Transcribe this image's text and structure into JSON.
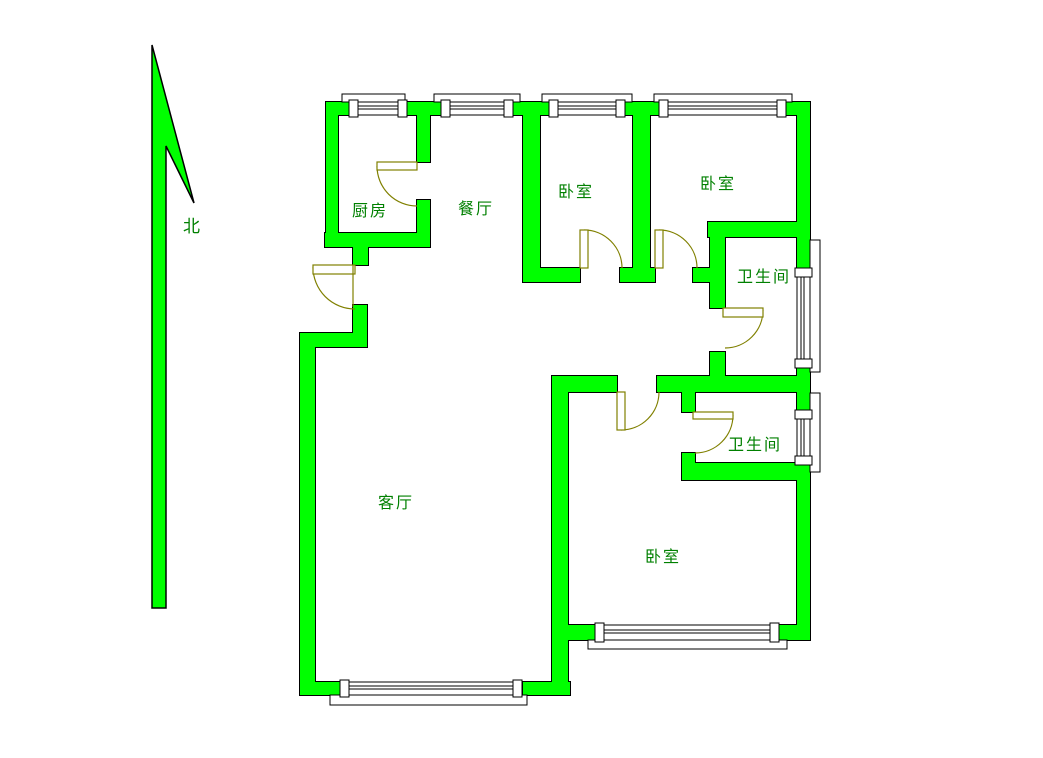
{
  "page": {
    "background": "#ffffff",
    "width": 1043,
    "height": 758
  },
  "colors": {
    "wall_fill": "#00ff00",
    "wall_outline": "#000000",
    "door": "#808000",
    "label_text": "#008000",
    "window_fill": "#ffffff",
    "window_line": "#000000"
  },
  "compass": {
    "label": "北",
    "label_x": 183,
    "label_y": 232,
    "arrow_polygon": "152,45 194,203 166,146 166,608 152,608"
  },
  "rooms": [
    {
      "name": "kitchen",
      "label": "厨房",
      "x": 352,
      "y": 216
    },
    {
      "name": "dining-room",
      "label": "餐厅",
      "x": 458,
      "y": 214
    },
    {
      "name": "bedroom-north-1",
      "label": "卧室",
      "x": 558,
      "y": 197
    },
    {
      "name": "bedroom-north-2",
      "label": "卧室",
      "x": 700,
      "y": 189
    },
    {
      "name": "bathroom-north",
      "label": "卫生间",
      "x": 737,
      "y": 282
    },
    {
      "name": "bathroom-south",
      "label": "卫生间",
      "x": 728,
      "y": 450
    },
    {
      "name": "living-room",
      "label": "客厅",
      "x": 378,
      "y": 508
    },
    {
      "name": "bedroom-south",
      "label": "卧室",
      "x": 645,
      "y": 562
    }
  ],
  "plan": {
    "walls": [
      [
        326,
        102,
        24,
        13
      ],
      [
        407,
        102,
        35,
        13
      ],
      [
        513,
        102,
        37,
        13
      ],
      [
        625,
        102,
        35,
        13
      ],
      [
        785,
        102,
        25,
        13
      ],
      [
        326,
        102,
        12,
        145
      ],
      [
        325,
        233,
        105,
        14
      ],
      [
        417,
        102,
        13,
        60
      ],
      [
        417,
        200,
        13,
        40
      ],
      [
        353,
        247,
        15,
        18
      ],
      [
        353,
        305,
        14,
        35
      ],
      [
        300,
        333,
        67,
        14
      ],
      [
        300,
        333,
        15,
        362
      ],
      [
        300,
        682,
        47,
        13
      ],
      [
        523,
        682,
        47,
        13
      ],
      [
        552,
        376,
        16,
        319
      ],
      [
        552,
        625,
        48,
        15
      ],
      [
        775,
        625,
        35,
        15
      ],
      [
        523,
        268,
        57,
        14
      ],
      [
        620,
        268,
        35,
        14
      ],
      [
        693,
        268,
        32,
        14
      ],
      [
        523,
        102,
        17,
        180
      ],
      [
        633,
        102,
        17,
        180
      ],
      [
        708,
        222,
        102,
        15
      ],
      [
        710,
        222,
        15,
        86
      ],
      [
        710,
        352,
        15,
        40
      ],
      [
        552,
        376,
        65,
        16
      ],
      [
        657,
        376,
        153,
        16
      ],
      [
        682,
        376,
        13,
        36
      ],
      [
        682,
        453,
        13,
        27
      ],
      [
        682,
        463,
        128,
        17
      ],
      [
        797,
        102,
        13,
        166
      ],
      [
        797,
        368,
        13,
        42
      ],
      [
        797,
        465,
        13,
        175
      ]
    ],
    "windows": [
      {
        "dir": "h",
        "pillars": [
          [
            349,
            100,
            9,
            17
          ],
          [
            398,
            100,
            9,
            17
          ]
        ],
        "glass": [
          358,
          102,
          40,
          13
        ],
        "sill": [
          342,
          94,
          63,
          8
        ]
      },
      {
        "dir": "h",
        "pillars": [
          [
            441,
            100,
            9,
            17
          ],
          [
            504,
            100,
            9,
            17
          ]
        ],
        "glass": [
          450,
          102,
          54,
          13
        ],
        "sill": [
          434,
          94,
          86,
          8
        ]
      },
      {
        "dir": "h",
        "pillars": [
          [
            549,
            100,
            9,
            17
          ],
          [
            616,
            100,
            9,
            17
          ]
        ],
        "glass": [
          558,
          102,
          58,
          13
        ],
        "sill": [
          542,
          94,
          90,
          8
        ]
      },
      {
        "dir": "h",
        "pillars": [
          [
            659,
            100,
            9,
            17
          ],
          [
            777,
            100,
            9,
            17
          ]
        ],
        "glass": [
          668,
          102,
          109,
          13
        ],
        "sill": [
          654,
          94,
          138,
          8
        ]
      },
      {
        "dir": "v",
        "pillars": [
          [
            795,
            268,
            17,
            9
          ],
          [
            795,
            359,
            17,
            9
          ]
        ],
        "glass": [
          797,
          277,
          13,
          82
        ],
        "sill": [
          810,
          240,
          10,
          132
        ]
      },
      {
        "dir": "v",
        "pillars": [
          [
            795,
            410,
            17,
            9
          ],
          [
            795,
            456,
            17,
            9
          ]
        ],
        "glass": [
          797,
          419,
          13,
          37
        ],
        "sill": [
          810,
          393,
          10,
          79
        ]
      },
      {
        "dir": "h",
        "pillars": [
          [
            340,
            680,
            9,
            17
          ],
          [
            513,
            680,
            9,
            17
          ]
        ],
        "glass": [
          349,
          682,
          164,
          13
        ],
        "sill": [
          330,
          695,
          197,
          10
        ]
      },
      {
        "dir": "h",
        "pillars": [
          [
            595,
            623,
            9,
            19
          ],
          [
            770,
            623,
            9,
            19
          ]
        ],
        "glass": [
          604,
          625,
          166,
          15
        ],
        "sill": [
          588,
          640,
          199,
          9
        ]
      }
    ],
    "doors": [
      {
        "name": "entry-door",
        "leaf": [
          313,
          265,
          42,
          9
        ],
        "arc": "M 313 267 A 42 42 0 0 0 355 309",
        "line": [
          353,
          265,
          353,
          307
        ]
      },
      {
        "name": "kitchen-door",
        "leaf": [
          377,
          162,
          40,
          8
        ],
        "arc": "M 377 166 A 40 40 0 0 0 417 206"
      },
      {
        "name": "bedroom-1-door",
        "leaf": [
          580,
          230,
          8,
          38
        ],
        "arc": "M 584 230 A 38 38 0 0 1 622 268"
      },
      {
        "name": "bedroom-2-door",
        "leaf": [
          655,
          230,
          8,
          38
        ],
        "arc": "M 659 230 A 38 38 0 0 1 697 268"
      },
      {
        "name": "bedroom-3-door",
        "leaf": [
          617,
          392,
          8,
          38
        ],
        "arc": "M 621 430 A 38 38 0 0 0 659 392"
      },
      {
        "name": "bathroom-1-door",
        "leaf": [
          723,
          308,
          40,
          9
        ],
        "arc": "M 763 310 A 38 38 0 0 1 725 348"
      },
      {
        "name": "bathroom-2-door",
        "leaf": [
          693,
          412,
          40,
          7
        ],
        "arc": "M 733 415 A 38 38 0 0 1 695 453"
      }
    ]
  }
}
